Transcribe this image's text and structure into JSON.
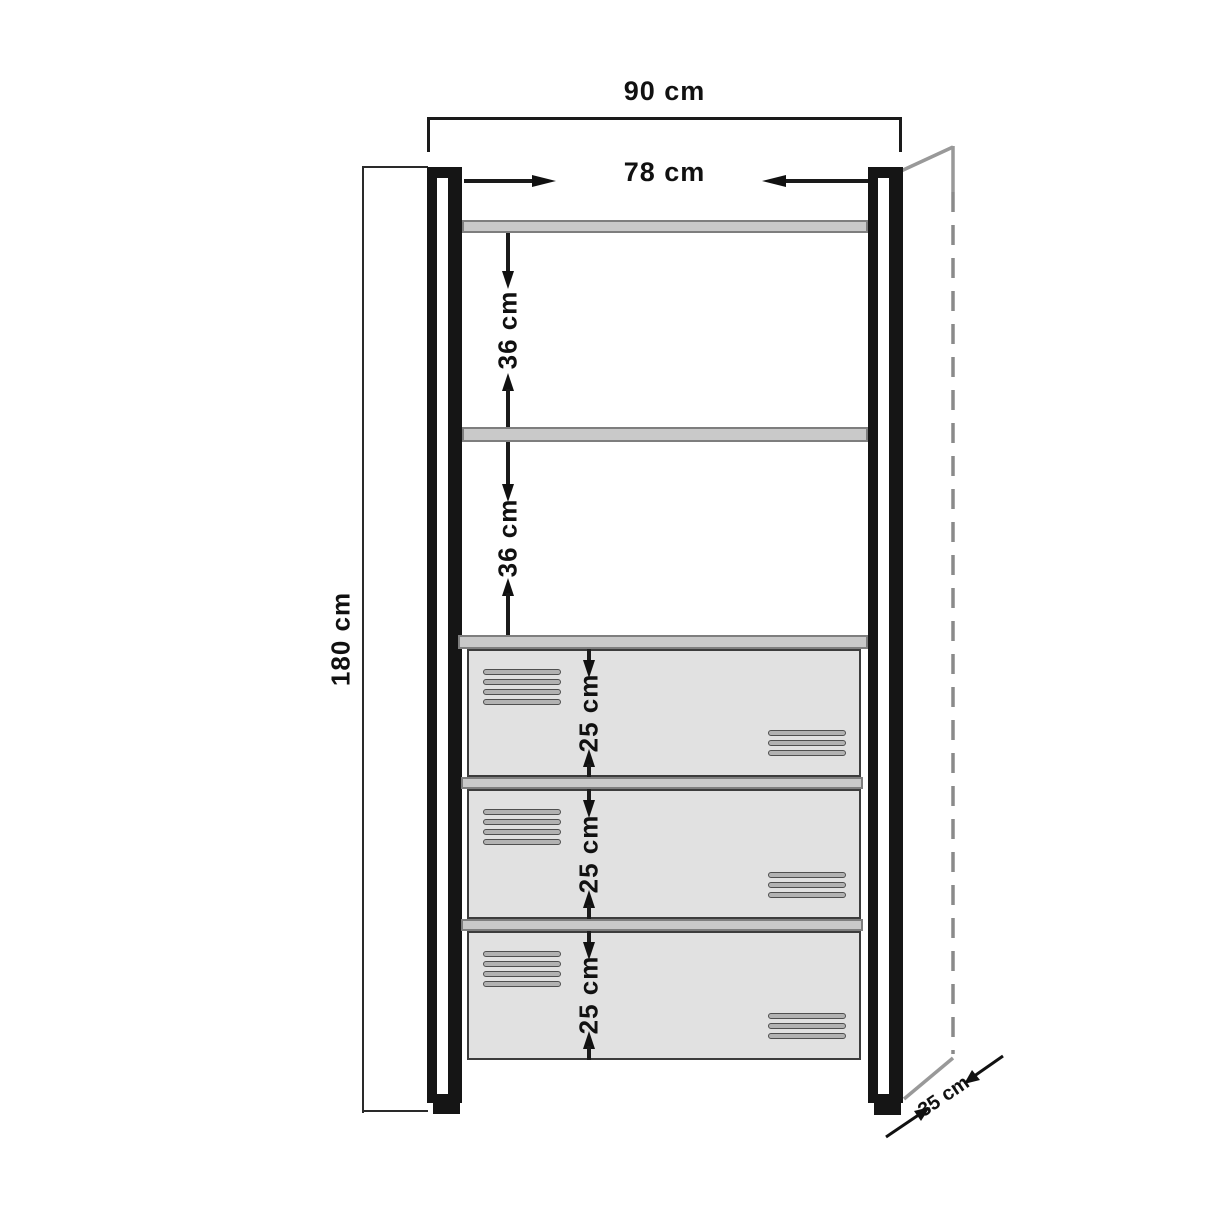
{
  "diagram": {
    "type": "furniture-dimension-drawing",
    "subject": "tall shelving unit with two open shelves and three vented drawers",
    "units": "cm",
    "total_width_cm": 90,
    "inner_width_cm": 78,
    "height_cm": 180,
    "shelf_gap_cm": [
      36,
      36
    ],
    "drawer_height_cm": [
      25,
      25,
      25
    ],
    "depth_cm": 35
  },
  "labels": {
    "total_width": "90 cm",
    "inner_width": "78 cm",
    "height": "180 cm",
    "gap_1": "36 cm",
    "gap_2": "36 cm",
    "drawer_1": "25 cm",
    "drawer_2": "25 cm",
    "drawer_3": "25 cm",
    "depth": "35 cm"
  },
  "colors": {
    "line": "#1a1a1a",
    "text": "#111111",
    "shelf_fill": "#c9c9c9",
    "shelf_border": "#7e7e7e",
    "drawer_fill": "#e1e1e1",
    "drawer_border": "#3c3c3c",
    "vent_fill": "#b2b2b2",
    "vent_border": "#4f4f4f",
    "perspective_line": "#999999",
    "background": "#ffffff"
  }
}
